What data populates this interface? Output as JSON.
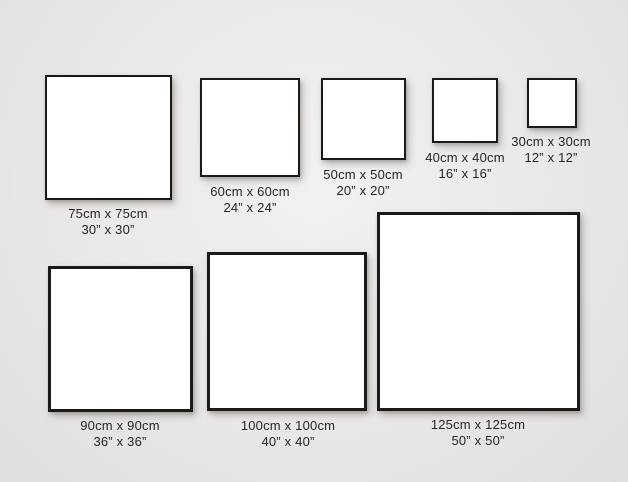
{
  "page": {
    "description": "Square canvas size comparison chart",
    "colors": {
      "background_center": "#f2f1ef",
      "background_edge": "#e0dedc",
      "frame_border": "#1b1a19",
      "frame_fill": "#ffffff",
      "label_text": "#272522"
    }
  },
  "chart_data": {
    "type": "table",
    "title": "",
    "items": [
      {
        "size_cm": "75cm x 75cm",
        "size_in": "30” x 30”"
      },
      {
        "size_cm": "60cm x 60cm",
        "size_in": "24” x 24”"
      },
      {
        "size_cm": "50cm x 50cm",
        "size_in": "20” x 20”"
      },
      {
        "size_cm": "40cm x 40cm",
        "size_in": "16” x 16”"
      },
      {
        "size_cm": "30cm x 30cm",
        "size_in": "12” x 12”"
      },
      {
        "size_cm": "90cm x 90cm",
        "size_in": "36” x 36”"
      },
      {
        "size_cm": "100cm x 100cm",
        "size_in": "40” x 40”"
      },
      {
        "size_cm": "125cm x 125cm",
        "size_in": "50” x 50”"
      }
    ]
  },
  "frames": [
    {
      "id": "75cm",
      "label_cm": "75cm x 75cm",
      "label_inch": "30” x 30”",
      "box": {
        "x": 45,
        "y": 75,
        "w": 127,
        "h": 125,
        "border": 2
      },
      "label": {
        "cx": 108,
        "y": 206
      }
    },
    {
      "id": "60cm",
      "label_cm": "60cm x 60cm",
      "label_inch": "24” x 24”",
      "box": {
        "x": 200,
        "y": 78,
        "w": 100,
        "h": 99,
        "border": 2
      },
      "label": {
        "cx": 250,
        "y": 184
      }
    },
    {
      "id": "50cm",
      "label_cm": "50cm x 50cm",
      "label_inch": "20” x 20”",
      "box": {
        "x": 321,
        "y": 78,
        "w": 85,
        "h": 82,
        "border": 2
      },
      "label": {
        "cx": 363,
        "y": 167
      }
    },
    {
      "id": "40cm",
      "label_cm": "40cm x 40cm",
      "label_inch": "16” x 16”",
      "box": {
        "x": 432,
        "y": 78,
        "w": 66,
        "h": 65,
        "border": 2
      },
      "label": {
        "cx": 465,
        "y": 150
      }
    },
    {
      "id": "30cm",
      "label_cm": "30cm x 30cm",
      "label_inch": "12” x 12”",
      "box": {
        "x": 527,
        "y": 78,
        "w": 50,
        "h": 50,
        "border": 2
      },
      "label": {
        "cx": 551,
        "y": 134
      }
    },
    {
      "id": "90cm",
      "label_cm": "90cm x 90cm",
      "label_inch": "36” x 36”",
      "box": {
        "x": 48,
        "y": 266,
        "w": 145,
        "h": 146,
        "border": 3
      },
      "label": {
        "cx": 120,
        "y": 418
      }
    },
    {
      "id": "100cm",
      "label_cm": "100cm x 100cm",
      "label_inch": "40” x 40”",
      "box": {
        "x": 207,
        "y": 252,
        "w": 160,
        "h": 159,
        "border": 3
      },
      "label": {
        "cx": 288,
        "y": 418
      }
    },
    {
      "id": "125cm",
      "label_cm": "125cm x 125cm",
      "label_inch": "50” x 50”",
      "box": {
        "x": 377,
        "y": 212,
        "w": 203,
        "h": 199,
        "border": 3
      },
      "label": {
        "cx": 478,
        "y": 417
      }
    }
  ]
}
